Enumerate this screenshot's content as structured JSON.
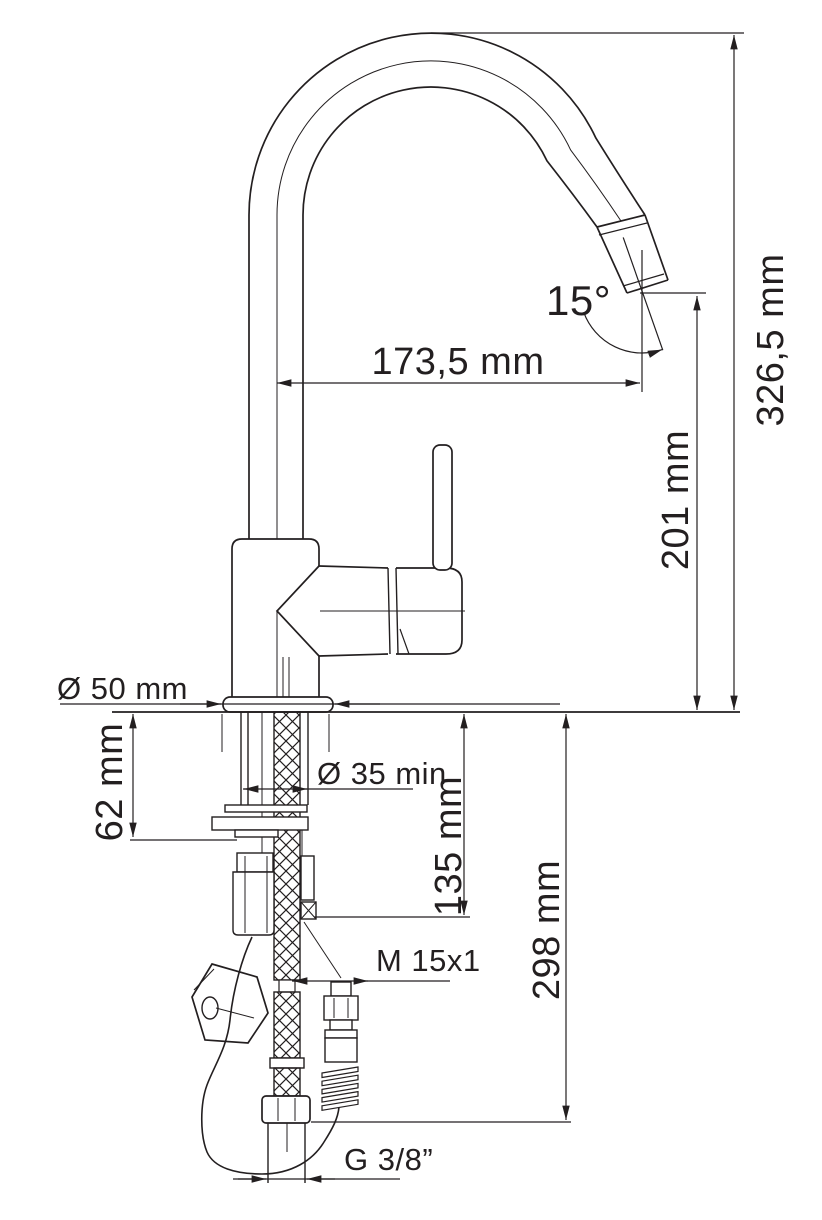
{
  "drawing": {
    "title": "Single-lever kitchen mixer with pull-out spray — installation dimension drawing",
    "background": "#ffffff",
    "line_color": "#231f20",
    "dimensions": {
      "total_height": "326,5 mm",
      "outlet_height": "201 mm",
      "spout_reach": "173,5 mm",
      "head_angle": "15°",
      "base_diameter": "Ø 50 mm",
      "deck_thickness": "62 mm",
      "mounting_hole": "Ø 35 min",
      "hose_connector_drop": "135 mm",
      "supply_hose_drop": "298 mm",
      "spray_hose_thread": "M 15x1",
      "supply_connection_thread": "G 3/8”"
    }
  }
}
